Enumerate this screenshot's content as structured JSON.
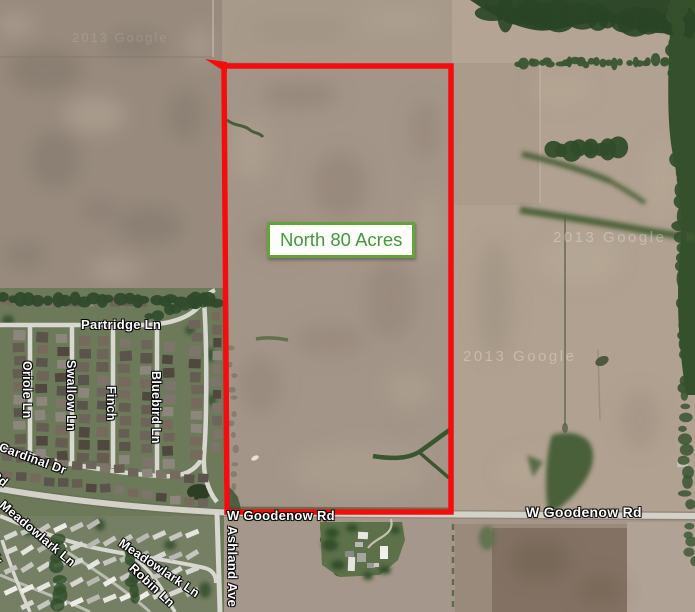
{
  "parcel": {
    "label": "North 80 Acres"
  },
  "roads": {
    "partridge": "Partridge Ln",
    "oriole": "Oriole Ln",
    "swallow": "Swallow Ln",
    "finch": "Finch",
    "bluebird": "Bluebird Ln",
    "cardinal": "Cardinal Dr",
    "rd_partial": "Rd",
    "meadowlark1": "Meadowlark Ln",
    "cir_partial": "Cir",
    "meadowlark2": "Meadowlark Ln",
    "robin": "Robin Ln",
    "ashland": "Ashland Ave",
    "goodenow_left": "W Goodenow Rd",
    "goodenow_right": "W Goodenow Rd"
  },
  "watermarks": {
    "w1": "2013 Google",
    "w2": "2013 Google",
    "w3": "2013 Google"
  },
  "colors": {
    "boundary_red": "#f30d0d",
    "label_green_border": "#63a23c",
    "label_green_text": "#479640",
    "label_bg": "#fdfdfa",
    "street_label_text": "#ffffff"
  }
}
